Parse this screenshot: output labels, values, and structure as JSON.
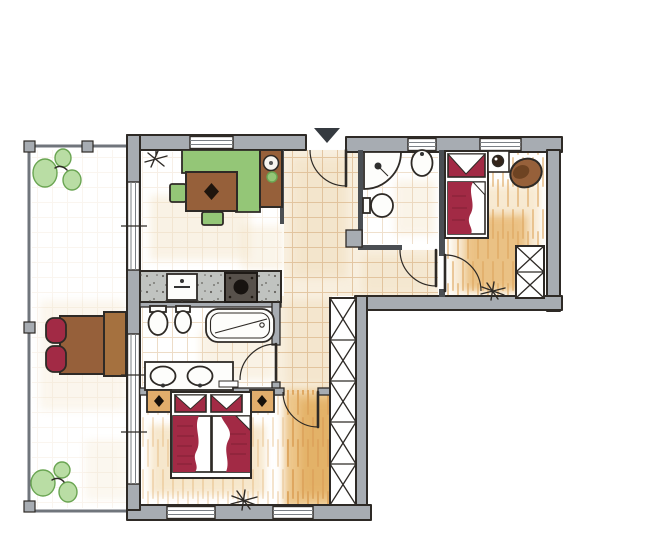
{
  "plan": {
    "type": "hand-drawn-apartment-floor-plan",
    "entrance_marker": "black-triangle-top",
    "rooms": [
      {
        "name": "balcony",
        "floor": "light-tile",
        "furniture": [
          "plant-top",
          "plant-bottom",
          "outdoor-table",
          "red-chair",
          "red-chair",
          "railing",
          "railing-posts"
        ]
      },
      {
        "name": "kitchen-dining",
        "floor": "tile",
        "furniture": [
          "pendant-lamp",
          "corner-bench-green",
          "dining-table-brown",
          "green-chair",
          "green-chair",
          "sideboard-with-round-sink",
          "potted-plant",
          "kitchen-counter",
          "kitchen-sink",
          "stove"
        ]
      },
      {
        "name": "hallway",
        "floor": "tile",
        "furniture": [
          "entrance-door",
          "hall-wardrobe-5-cells",
          "duct-pier"
        ]
      },
      {
        "name": "bathroom-main",
        "floor": "tile",
        "furniture": [
          "toilet",
          "bidet",
          "bathtub",
          "double-vanity",
          "door"
        ]
      },
      {
        "name": "bedroom-master",
        "floor": "wood",
        "furniture": [
          "double-bed-red",
          "nightstand-with-lamp",
          "nightstand-with-lamp",
          "floor-plant",
          "door"
        ]
      },
      {
        "name": "bathroom-small",
        "floor": "tile",
        "furniture": [
          "corner-shower",
          "washbasin",
          "toilet",
          "door"
        ]
      },
      {
        "name": "bedroom-single",
        "floor": "wood",
        "furniture": [
          "single-bed-red",
          "nightstand-with-lamp",
          "armchair-brown",
          "wardrobe-2-cells",
          "floor-plant",
          "door"
        ]
      }
    ],
    "window_count": 7,
    "door_count": 5
  },
  "colors": {
    "ink": "#2e2a26",
    "wall_fill": "#a7acb2",
    "thin_wall": "#4a4e53",
    "rail": "#70757c",
    "tile_line": "#d8b183",
    "tile_base": "#f8efdf",
    "wood_wash": "#f0d4a4",
    "wood_stroke": "#dda45c",
    "green_fill": "#94c677",
    "green_light": "#b9dda4",
    "green_dark": "#6aa552",
    "brown_fill": "#96603a",
    "brown_dark": "#6e4322",
    "red_fill": "#a22a45",
    "red_dark": "#7e1f33",
    "tan_fill": "#e2ad6c",
    "counter_fill": "#c0c3c0",
    "triangle": "#353a40"
  }
}
